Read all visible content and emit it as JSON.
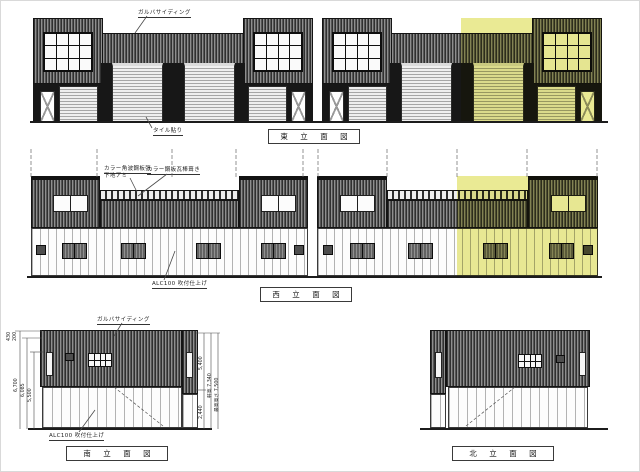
{
  "sheet": {
    "background": "#ffffff",
    "highlight_color": "#e3e370"
  },
  "east_elevation": {
    "title": "東 立 面 図",
    "notes": {
      "siding": "ガルバサイディング",
      "tile": "タイル貼り"
    }
  },
  "west_elevation": {
    "title": "西 立 面 図",
    "notes": {
      "wall_l1": "カラー角波鋼板張",
      "wall_l2": "下地アミ",
      "roof": "カラー鋼板瓦棒葺き",
      "alc": "ALC100 吹付仕上げ"
    }
  },
  "south_elevation": {
    "title": "南 立 面 図",
    "notes": {
      "siding": "ガルバサイディング",
      "alc": "ALC100 吹付仕上げ"
    },
    "dims_left": [
      "430",
      "200",
      "6,700",
      "6,085",
      "5,500"
    ],
    "dims_right": [
      "5,400",
      "2,440",
      "軒高 7,340",
      "最高高さ 7,500"
    ]
  },
  "north_elevation": {
    "title": "北 立 面 図"
  }
}
